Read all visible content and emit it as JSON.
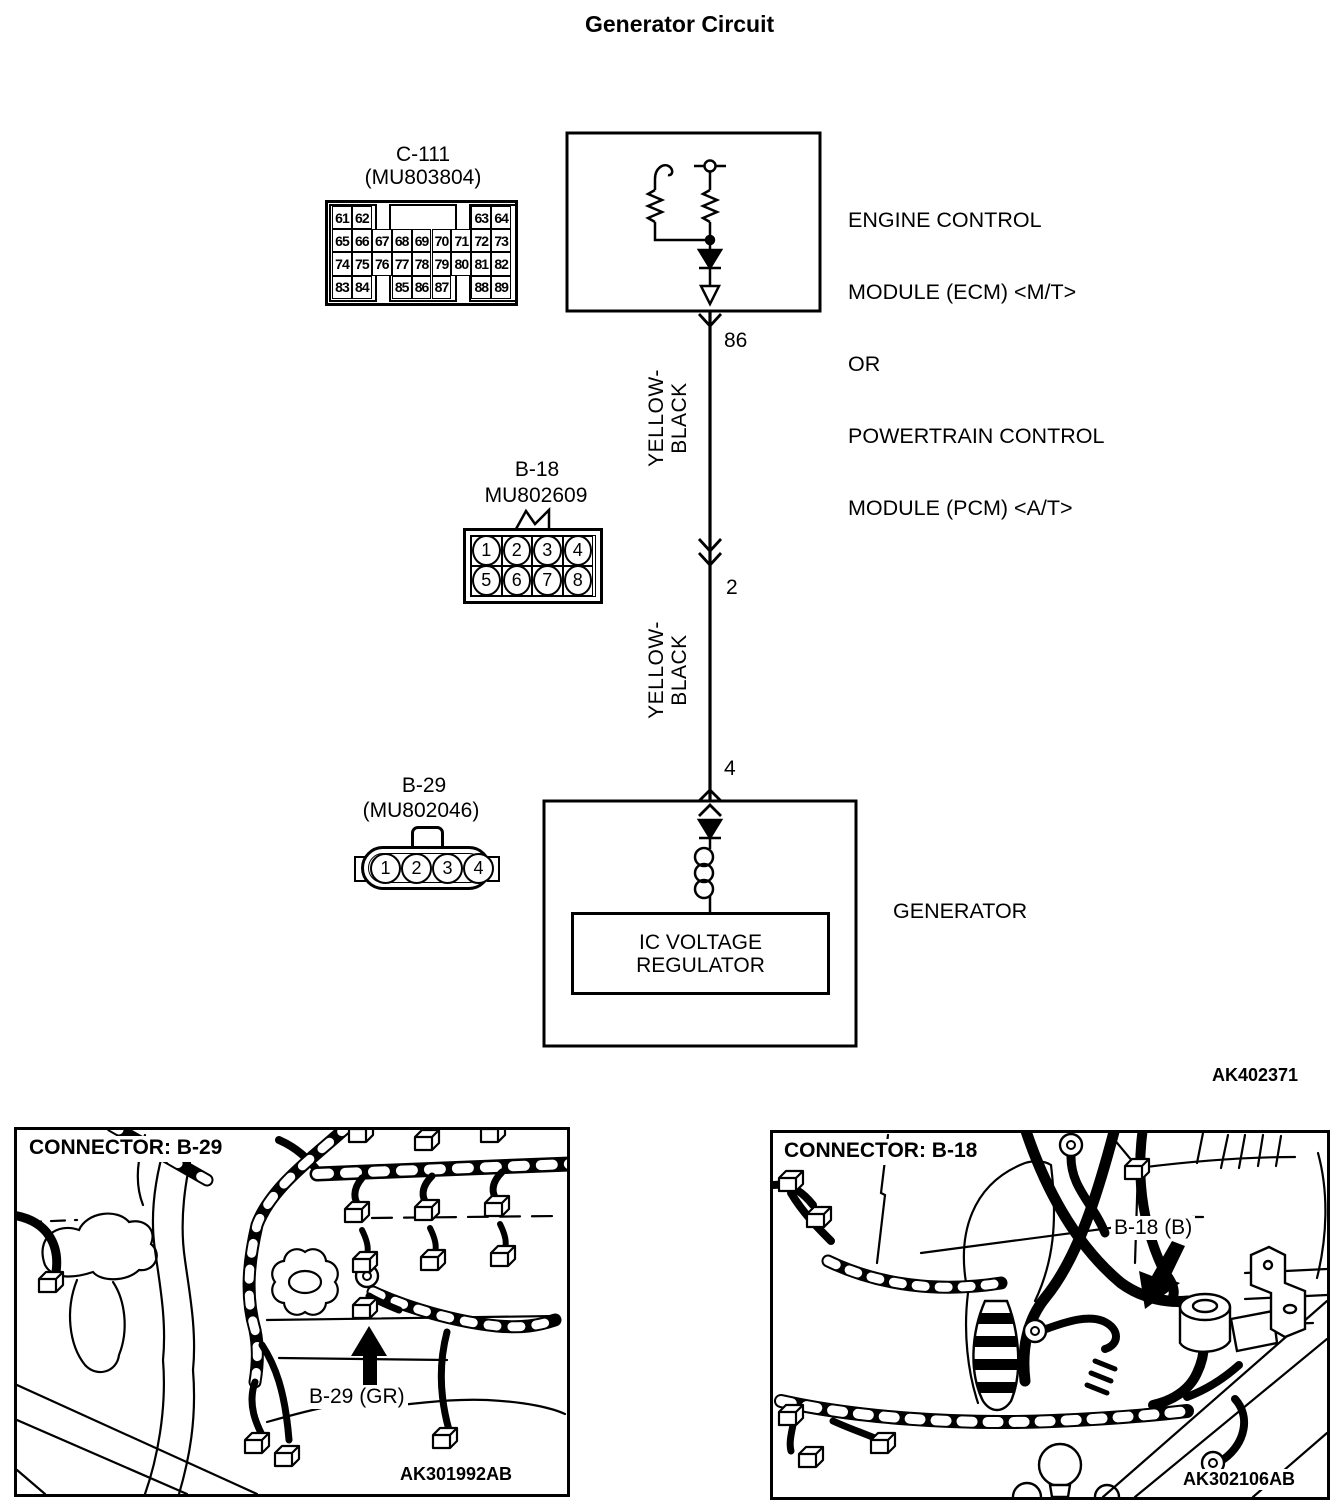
{
  "title": "Generator Circuit",
  "diagram_code": "AK402371",
  "ecm": {
    "lines": [
      "ENGINE CONTROL",
      "MODULE (ECM) <M/T>",
      "OR",
      "POWERTRAIN CONTROL",
      "MODULE (PCM) <A/T>"
    ]
  },
  "c111": {
    "name": "C-111",
    "part": "(MU803804)",
    "grid_rows": [
      [
        "61",
        "62",
        "",
        "",
        "",
        "",
        "",
        "63",
        "64"
      ],
      [
        "65",
        "66",
        "67",
        "68",
        "69",
        "70",
        "71",
        "72",
        "73"
      ],
      [
        "74",
        "75",
        "76",
        "77",
        "78",
        "79",
        "80",
        "81",
        "82"
      ],
      [
        "83",
        "84",
        "",
        "85",
        "86",
        "87",
        "",
        "88",
        "89"
      ]
    ]
  },
  "wire": {
    "pin_86": "86",
    "pin_2": "2",
    "pin_4": "4",
    "color_top": [
      "YELLOW-",
      "BLACK"
    ],
    "color_bottom": [
      "YELLOW-",
      "BLACK"
    ]
  },
  "b18": {
    "name": "B-18",
    "part": "MU802609",
    "pins": [
      "1",
      "2",
      "3",
      "4",
      "5",
      "6",
      "7",
      "8"
    ]
  },
  "b29": {
    "name": "B-29",
    "part": "(MU802046)",
    "pins": [
      "1",
      "2",
      "3",
      "4"
    ]
  },
  "generator": {
    "label": "GENERATOR",
    "regulator_line1": "IC VOLTAGE",
    "regulator_line2": "REGULATOR"
  },
  "photo_b29": {
    "header": "CONNECTOR: B-29",
    "callout": "B-29 (GR)",
    "code": "AK301992AB"
  },
  "photo_b18": {
    "header": "CONNECTOR: B-18",
    "callout": "B-18 (B)",
    "code": "AK302106AB"
  }
}
